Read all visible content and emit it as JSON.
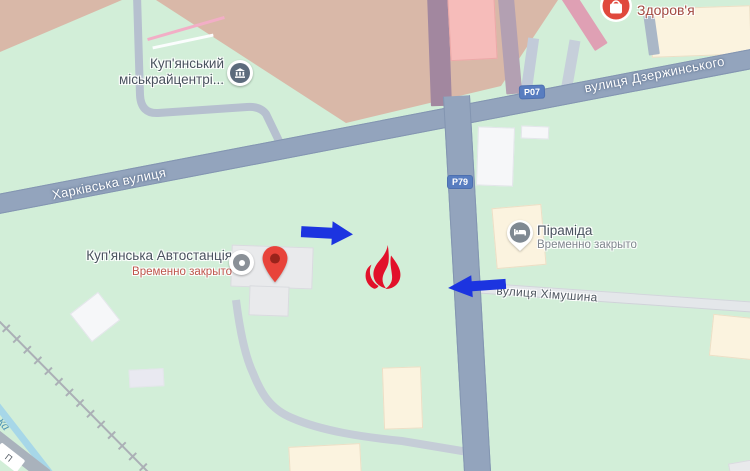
{
  "streets": {
    "kharkivska": "Харківська вулиця",
    "dzerzhynskoho": "вулиця Дзержинського",
    "khimushyna": "вулиця Хімушина",
    "badge_p07": "Р07",
    "badge_p79": "Р79"
  },
  "pois": {
    "miskraitsentr": {
      "line1": "Куп'янський",
      "line2": "міськрайцентрі...",
      "icon": "government-building-icon"
    },
    "avtostantsiia": {
      "name": "Куп'янська Автостанція",
      "status": "Временно закрыто",
      "icon": "gray-dot-poi-icon",
      "marker": "red-map-pin"
    },
    "piramida": {
      "name": "Піраміда",
      "status": "Временно закрыто",
      "icon": "hotel-bed-pin-icon"
    },
    "zdorovia": {
      "name": "Здоров'я",
      "icon": "red-store-circle-icon"
    }
  },
  "water": {
    "partial_label": "ка"
  },
  "corner_road": {
    "partial_label": "П"
  },
  "annotations": {
    "arrow_color": "#1c34e0",
    "flame_color": "#e2112a",
    "items": [
      "arrow-pointing-right",
      "arrow-pointing-left",
      "flame-marker"
    ]
  },
  "colors": {
    "map_green": "#d2eed8",
    "district_tan": "#d9b8a8",
    "road_major": "#93a4bd",
    "route_badge_blue": "#587dc0",
    "building_cream": "#fbf3df",
    "building_highlight_pink": "#f6bcba",
    "red_pin": "#e8433a",
    "water_blue": "#a7d7e8"
  }
}
